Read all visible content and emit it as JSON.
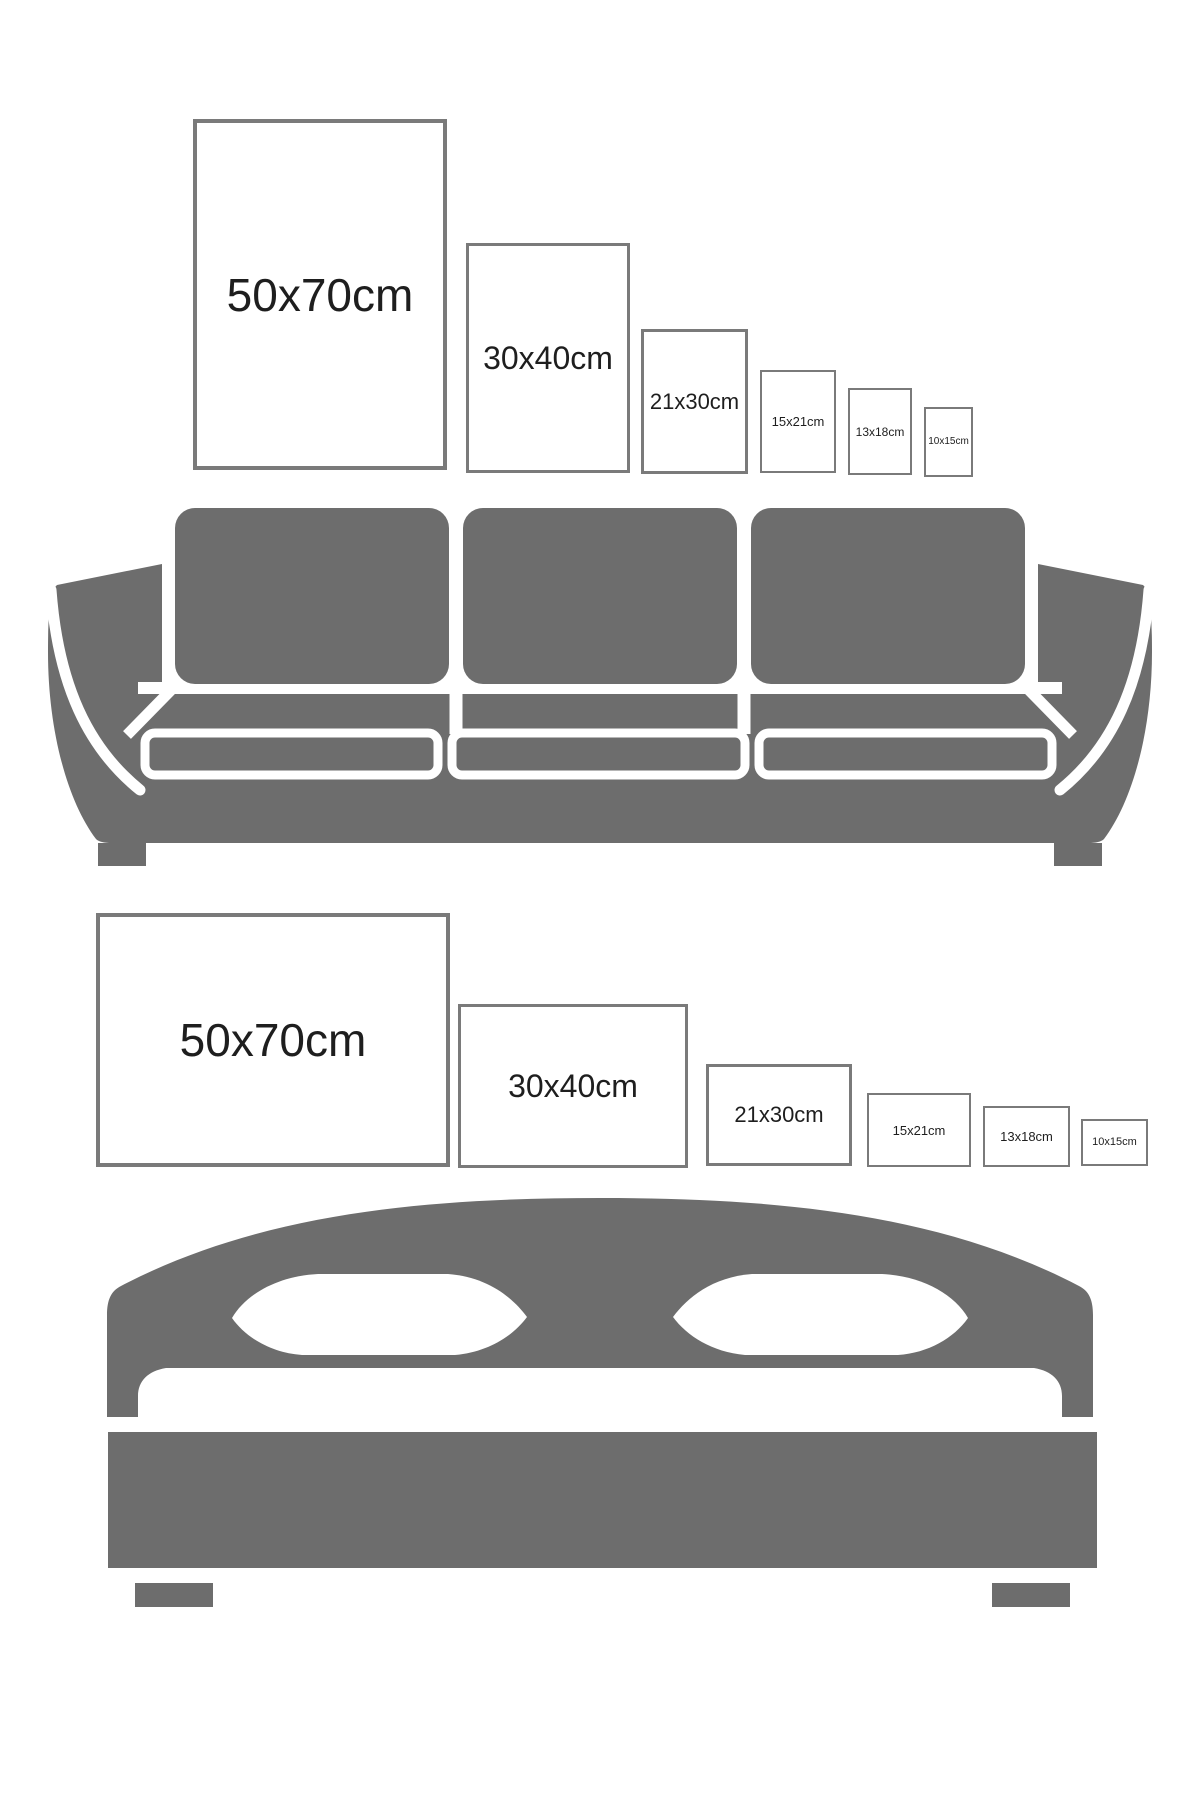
{
  "palette": {
    "furniture_gray": "#6d6d6d",
    "frame_border": "#7a7a7a",
    "frame_fill": "#ffffff",
    "label_color": "#1e1e1e",
    "page_bg": "#ffffff"
  },
  "sofa_section": {
    "furniture_icon": "sofa-icon",
    "orientation": "portrait",
    "frames": [
      {
        "label": "50x70cm",
        "size": "50x70"
      },
      {
        "label": "30x40cm",
        "size": "30x40"
      },
      {
        "label": "21x30cm",
        "size": "21x30"
      },
      {
        "label": "15x21cm",
        "size": "15x21"
      },
      {
        "label": "13x18cm",
        "size": "13x18"
      },
      {
        "label": "10x15cm",
        "size": "10x15"
      }
    ]
  },
  "bed_section": {
    "furniture_icon": "bed-icon",
    "orientation": "landscape",
    "frames": [
      {
        "label": "50x70cm",
        "size": "50x70"
      },
      {
        "label": "30x40cm",
        "size": "30x40"
      },
      {
        "label": "21x30cm",
        "size": "21x30"
      },
      {
        "label": "15x21cm",
        "size": "15x21"
      },
      {
        "label": "13x18cm",
        "size": "13x18"
      },
      {
        "label": "10x15cm",
        "size": "10x15"
      }
    ]
  }
}
